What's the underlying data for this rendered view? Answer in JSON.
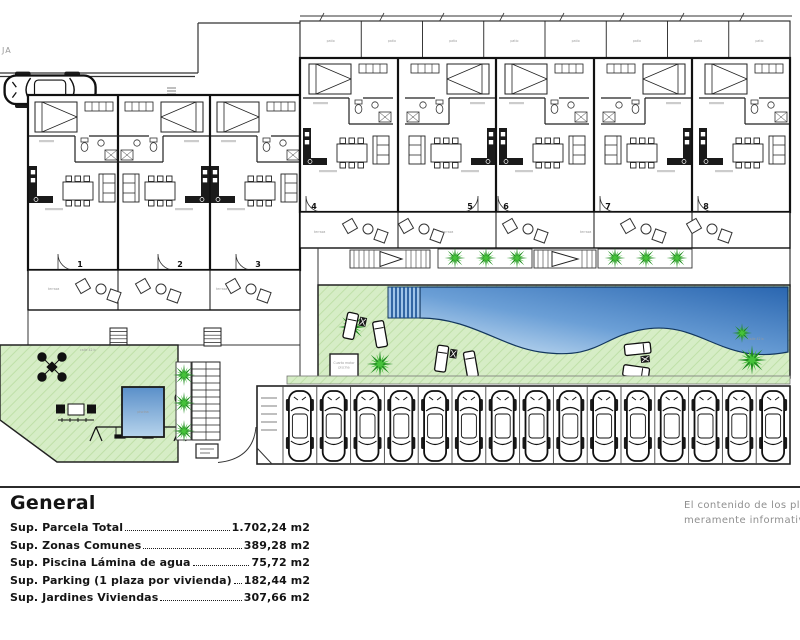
{
  "plan": {
    "street_label": "JA",
    "left_block_units": [
      {
        "number": "1"
      },
      {
        "number": "2"
      },
      {
        "number": "3"
      }
    ],
    "right_block_units": [
      {
        "number": "4"
      },
      {
        "number": "5"
      },
      {
        "number": "6"
      },
      {
        "number": "7"
      },
      {
        "number": "8"
      }
    ],
    "labels": {
      "patio": "patio",
      "terraza": "terraza",
      "street_small": "calle 42 b",
      "pool_room_1": "Cuarto motor",
      "pool_room_2": "piscina",
      "kids_pool": "piscina"
    },
    "parking": {
      "spaces": 15
    },
    "colors": {
      "lawn": "#d6edc6",
      "lawn_line": "#bfe0a8",
      "palm_dark": "#1f8c1f",
      "palm_light": "#46c23a",
      "pool_deep": "#2a66b0",
      "pool_light": "#d3e7f6",
      "pool_steps": "#184f92",
      "wall": "#1a1a1a",
      "grey_text": "#8f8f8f"
    }
  },
  "legend": {
    "title": "General",
    "rows": [
      {
        "label": "Sup. Parcela Total",
        "value": "1.702,24 m2"
      },
      {
        "label": "Sup. Zonas Comunes",
        "value": "389,28 m2"
      },
      {
        "label": "Sup. Piscina Lámina de agua",
        "value": "75,72 m2"
      },
      {
        "label": "Sup. Parking (1 plaza por vivienda)",
        "value": "182,44 m2"
      },
      {
        "label": "Sup. Jardines Viviendas",
        "value": "307,66 m2"
      }
    ]
  },
  "disclaimer": {
    "line1": "El contenido de los pl",
    "line2": "meramente informativ"
  }
}
